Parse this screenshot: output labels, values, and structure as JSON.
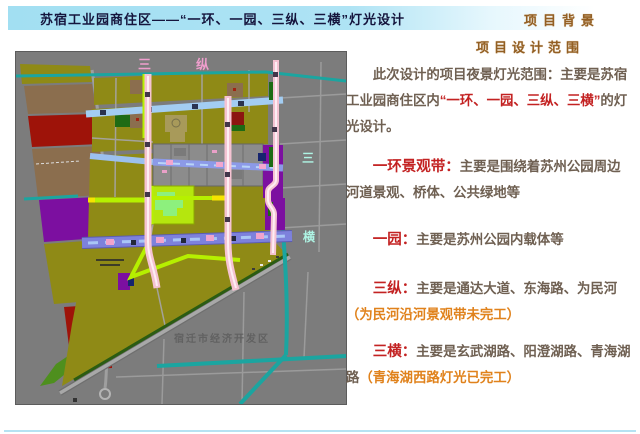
{
  "slide": {
    "title": "苏宿工业园商住区——“一环、一园、三纵、三横”灯光设计",
    "corner_label": "项目背景",
    "section_heading": "项目设计范围"
  },
  "content": {
    "intro": {
      "pre": "此次设计的项目夜景灯光范围：主要是苏宿工业园商住区内",
      "highlight": "“一环、一园、三纵、三横”",
      "post": "的灯光设计。"
    },
    "items": [
      {
        "term": "一环景观带：",
        "desc": "主要是围绕着苏州公园周边河道景观、桥体、公共绿地等"
      },
      {
        "term": "一园：",
        "desc": "主要是苏州公园内载体等"
      },
      {
        "term": "三纵：",
        "desc": "主要是通达大道、东海路、为民河",
        "note": "（为民河沿河景观带未完工）"
      },
      {
        "term": "三横：",
        "desc": "主要是玄武湖路、阳澄湖路、青海湖路",
        "note": "（青海湖西路灯光已完工）"
      }
    ]
  },
  "map": {
    "labels": {
      "v1": "三",
      "v2": "纵",
      "h1": "三",
      "h2": "横",
      "district": "宿迁市经济开发区"
    },
    "colors": {
      "background": "#7c7c7c",
      "parcel_olive": "#8f8a16",
      "parcel_red": "#9e1309",
      "parcel_brown": "#8b6e4e",
      "parcel_purple": "#7c0fa0",
      "parcel_green": "#1e6b14",
      "park_green": "#b5e60e",
      "park_blob": "#8df07d",
      "road_blue": "#a3cdf2",
      "road_periwinkle": "#8c9ae8",
      "road_main": "#7d81dc",
      "road_pink": "#f5c3d2",
      "road_chartreuse": "#b6f000",
      "canal_teal": "#1ba5a0",
      "label_pink": "#ef9ecd",
      "label_cyan": "#aef4e4"
    }
  }
}
